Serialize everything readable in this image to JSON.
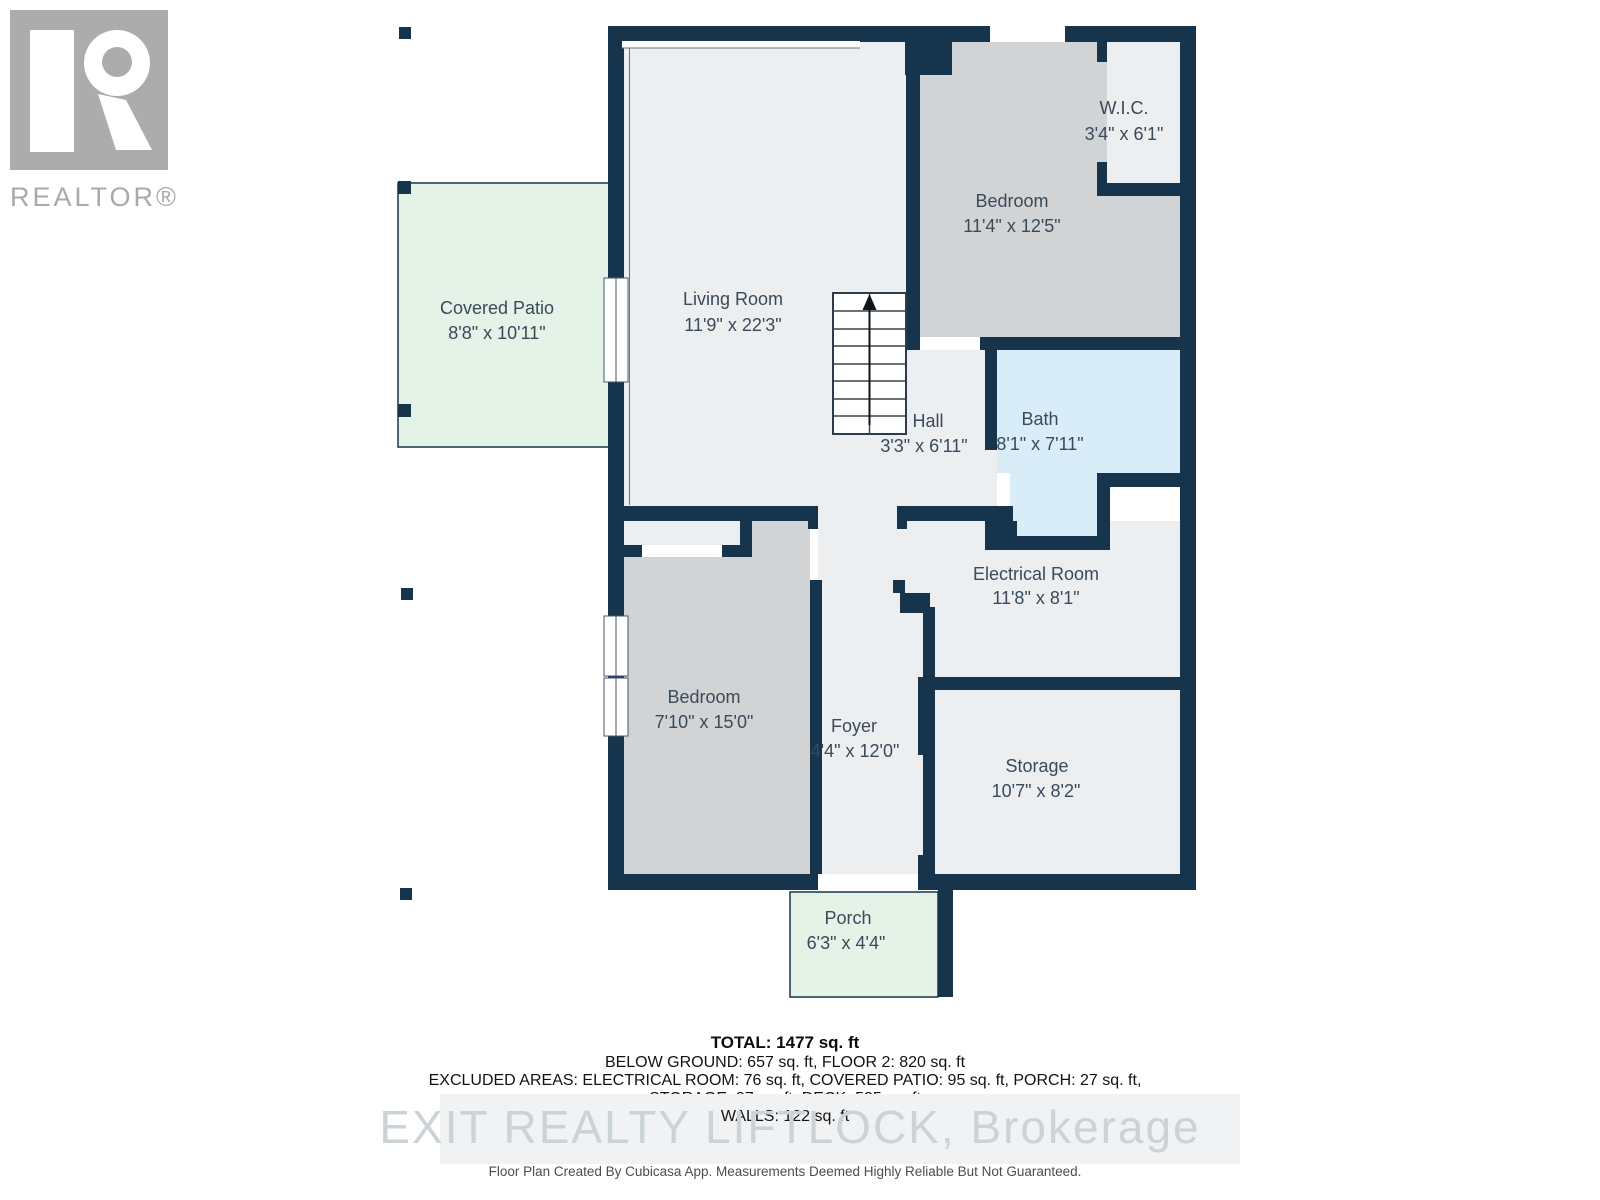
{
  "branding": {
    "realtor_logo_text": "REALTOR®"
  },
  "floorplan": {
    "rooms": [
      {
        "id": "covered-patio",
        "name": "Covered Patio",
        "dims": "8'8\" x 10'11\""
      },
      {
        "id": "living-room",
        "name": "Living Room",
        "dims": "11'9\" x 22'3\""
      },
      {
        "id": "bedroom-upper",
        "name": "Bedroom",
        "dims": "11'4\" x 12'5\""
      },
      {
        "id": "walk-in-closet",
        "name": "W.I.C.",
        "dims": "3'4\" x 6'1\""
      },
      {
        "id": "hall",
        "name": "Hall",
        "dims": "3'3\" x 6'11\""
      },
      {
        "id": "bath",
        "name": "Bath",
        "dims": "8'1\" x 7'11\""
      },
      {
        "id": "electrical-room",
        "name": "Electrical Room",
        "dims": "11'8\" x 8'1\""
      },
      {
        "id": "bedroom-lower",
        "name": "Bedroom",
        "dims": "7'10\" x 15'0\""
      },
      {
        "id": "foyer",
        "name": "Foyer",
        "dims": "4'4\" x 12'0\""
      },
      {
        "id": "storage",
        "name": "Storage",
        "dims": "10'7\" x 8'2\""
      },
      {
        "id": "porch",
        "name": "Porch",
        "dims": "6'3\" x 4'4\""
      }
    ]
  },
  "summary": {
    "total": "TOTAL: 1477 sq. ft",
    "line2": "BELOW GROUND: 657 sq. ft, FLOOR 2: 820 sq. ft",
    "line3": "EXCLUDED AREAS: ELECTRICAL ROOM: 76 sq. ft, COVERED PATIO: 95 sq. ft, PORCH: 27 sq. ft,",
    "line4": "STORAGE: 87 sq. ft, DECK: 535 sq. ft",
    "line5": "WALLS: 122 sq. ft"
  },
  "watermark": "EXIT REALTY LIFTLOCK, Brokerage",
  "disclaimer": "Floor Plan Created By Cubicasa App. Measurements Deemed Highly Reliable But Not Guaranteed.",
  "colors": {
    "wall": "#17344d",
    "floor": "#edeef0",
    "bedroom": "#d2d3d4",
    "bath": "#d9edf9",
    "outdoor": "#e4f2e8",
    "label": "#394a5a",
    "logo": "#acacac"
  }
}
